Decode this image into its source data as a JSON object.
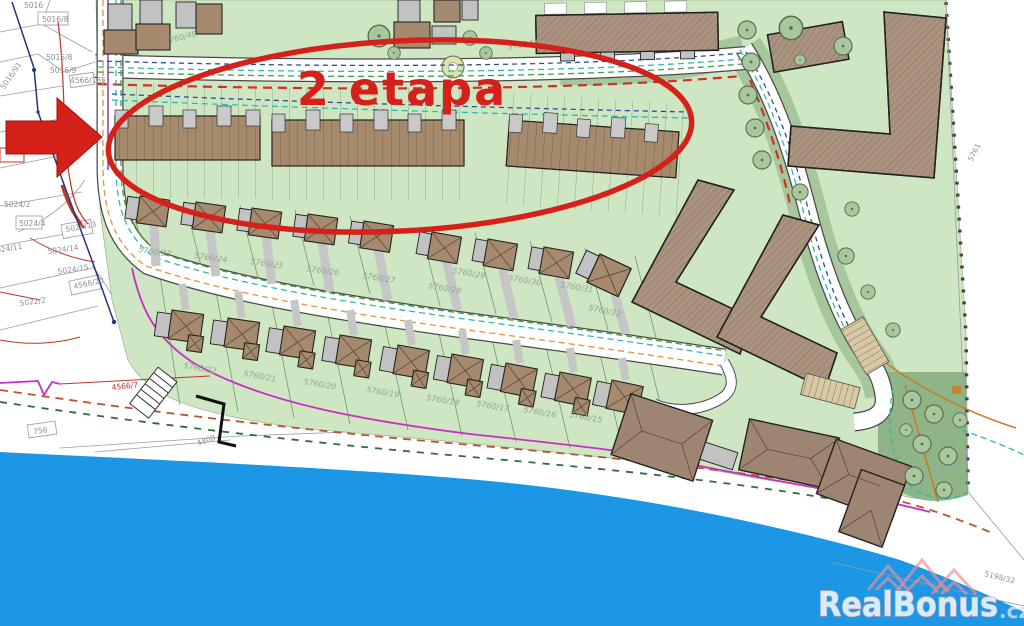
{
  "annotation": {
    "stage_label": "2 etapa"
  },
  "watermark": {
    "brand": "RealBonus",
    "domain_suffix": ".cz"
  },
  "colors": {
    "annotation_red": "#d6201a",
    "water_blue": "#1b97e5",
    "site_green": "#cfe6c2",
    "communal_green": "#a6c79b",
    "park_green": "#8fb488",
    "roof_brown": "#a68a6e",
    "garage_gray": "#c2c2c2",
    "road_white": "#ffffff",
    "boundary_magenta": "#c82fc8",
    "utility_cyan": "#2fb8ae",
    "utility_green": "#3f9d42",
    "utility_orange": "#e0953c",
    "utility_blue": "#2b4d9e",
    "watermark_pink": "#eba6b2"
  },
  "parcel_labels": [
    "5016",
    "5016/8",
    "5015/8",
    "5016/9",
    "4566/185",
    "5016/91",
    "5024/2",
    "5024/4",
    "5024/13",
    "5024/14",
    "5024/15",
    "4566/20",
    "5022/2",
    "5024/11",
    "4566/7",
    "756",
    "4808",
    "5760/49",
    "5760/50",
    "5760/23",
    "5760/24",
    "5760/25",
    "5760/26",
    "5760/27",
    "5760/28",
    "5760/29",
    "5760/30",
    "5760/31",
    "5760/32",
    "5760/22",
    "5760/21",
    "5760/20",
    "5760/19",
    "5760/18",
    "5760/17",
    "5760/16",
    "5760/15",
    "5761",
    "5198/26",
    "5198/32"
  ]
}
